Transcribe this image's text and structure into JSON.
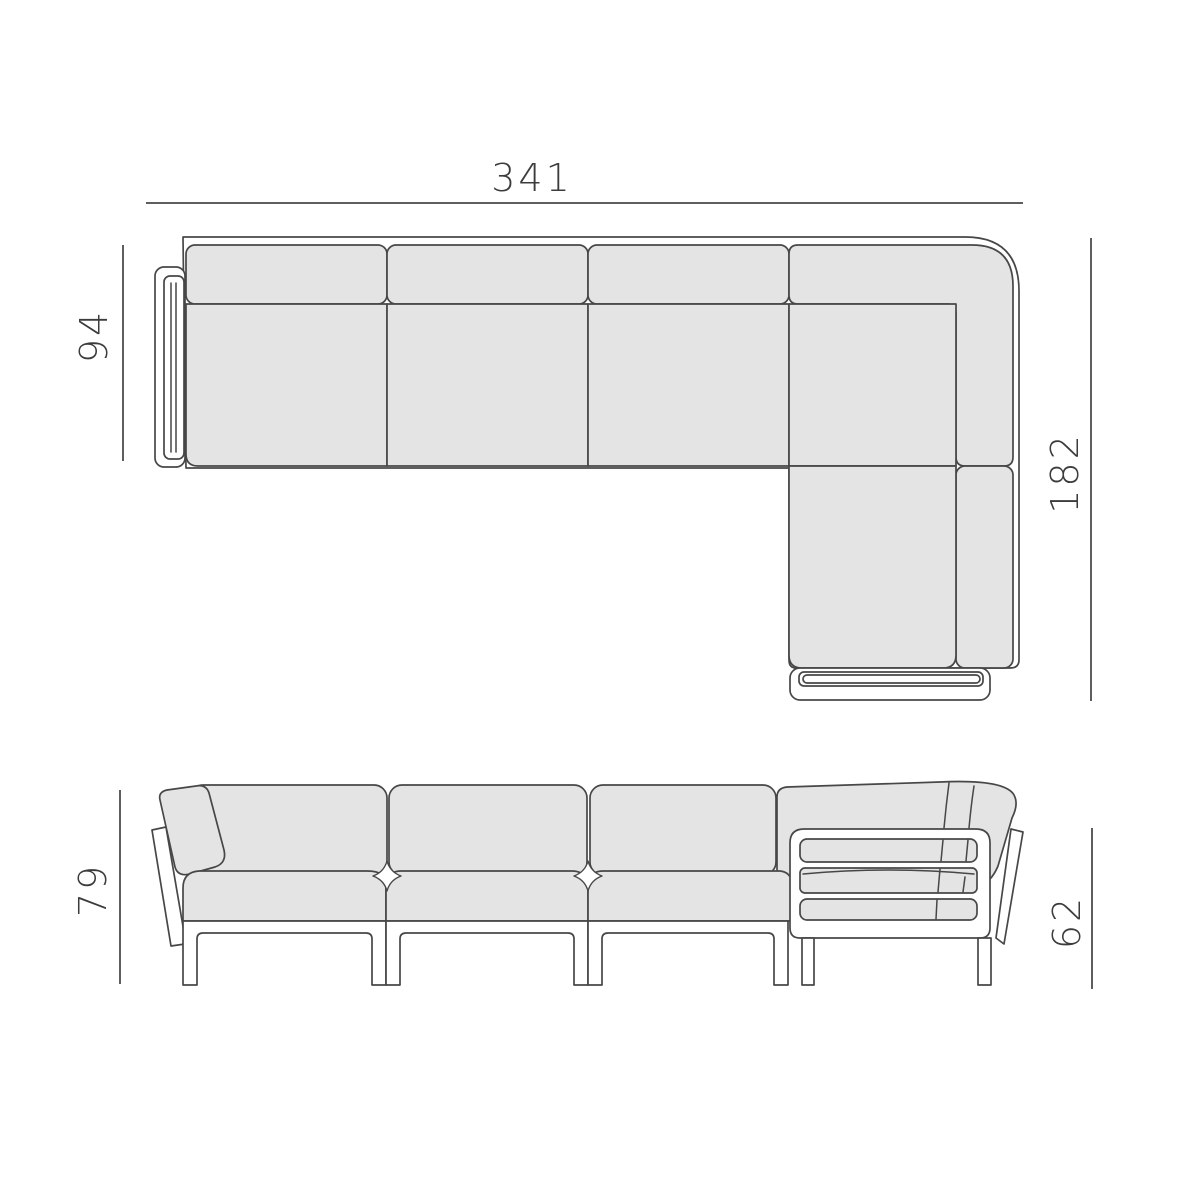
{
  "colors": {
    "page-bg": "#ffffff",
    "line-color": "#474747",
    "dim-line-color": "#5e5e5e",
    "cushion-fill": "#e4e4e4",
    "frame-fill": "#ffffff",
    "text-color": "#3c3c3c"
  },
  "top_view": {
    "overall_width": "341",
    "sofa_depth": "94",
    "chaise_depth": "182"
  },
  "front_view": {
    "back_height": "79",
    "arm_height": "62"
  }
}
